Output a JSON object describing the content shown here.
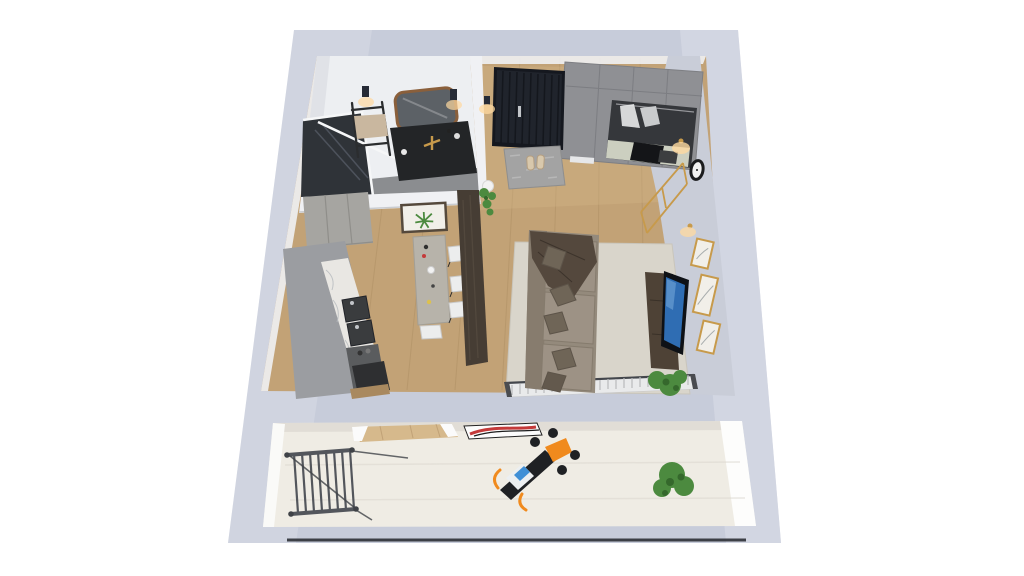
{
  "scene": {
    "title": "3d-apartment-floor-plan-render",
    "rooms": [
      "bathroom",
      "entry-hall",
      "wardrobe-nook",
      "kitchen",
      "dining-area",
      "living-area",
      "balcony"
    ],
    "objects": {
      "bathroom": [
        "walk-in-shower",
        "towel-ladder",
        "vanity-mirror",
        "vanity-sink",
        "wall-sconce",
        "wall-sconce"
      ],
      "entry_hall": [
        "entrance-door",
        "door-handle",
        "doormat",
        "slippers",
        "wall-sconce",
        "hanging-plant"
      ],
      "wardrobe_nook": [
        "wardrobe",
        "open-niche-with-clothes",
        "mattress",
        "black-pillow"
      ],
      "kitchen": [
        "tall-cabinets",
        "base-cabinets",
        "marble-countertop",
        "double-sink",
        "cooktop-oven"
      ],
      "dining_area": [
        "dining-table",
        "chair",
        "chair",
        "chair",
        "chair",
        "tableware"
      ],
      "living_area": [
        "area-rug",
        "sofa",
        "throw-blanket",
        "pillows",
        "tv-console",
        "tv",
        "potted-plant",
        "radiator",
        "wall-clock",
        "gold-coat-rack",
        "gallery-frame",
        "gallery-frame",
        "gallery-frame",
        "wall-sconce",
        "wall-sconce",
        "palm-artwork"
      ],
      "balcony": [
        "clothes-drying-rack",
        "exercise-bike",
        "potted-plant",
        "abstract-artwork"
      ]
    },
    "colors": {
      "background": "#ffffff",
      "wallSlab": "#c7ccda",
      "wallSlabLight": "#dde0e9",
      "wallInnerFace": "#c9cdd8",
      "wallWhite": "#f0f1f4",
      "bathWall": "#edeff2",
      "floorWood": "#c2a276",
      "floorWoodDark": "#ab8c62",
      "floorWoodLight": "#d6b98c",
      "balconyFloor": "#efece4",
      "balconyShade": "#dcd9d0",
      "bathFloor": "#8b8d90",
      "showerGlass": "#2f3338",
      "frameWhite": "#f6f7f8",
      "ladderFrame": "#2b2d2f",
      "towel": "#c9b79f",
      "mirrorFrame": "#8a5f3b",
      "mirrorGlass": "#5c6166",
      "vanityDark": "#232527",
      "gold": "#c79a4b",
      "doorNavy": "#20242c",
      "doorSlat": "#14171d",
      "handleSilver": "#c2c5c9",
      "sconceDark": "#262b36",
      "glowWarm": "#ffd9a0",
      "rugGray": "#a3a3a3",
      "slipper": "#d8c8ac",
      "wardrobeGray": "#8f9094",
      "wardrobeSeam": "#7a7b80",
      "nicheDark": "#35373b",
      "mattress": "#cccfc0",
      "pillowBlack": "#141518",
      "clockBlack": "#1b1c1e",
      "clockFace": "#f2f2f2",
      "artPaper": "#f1efe9",
      "kitchenCab": "#9b9da1",
      "kitchenUpper": "#a6a5a1",
      "marble": "#e9e7e3",
      "marbleVein": "#b9bcc0",
      "sinkDark": "#3a3c3e",
      "applianceDark": "#2e2f31",
      "tableTop": "#b7b3aa",
      "chairWhite": "#eceded",
      "partition": "#463d34",
      "rugLiving": "#d9d5cb",
      "sofaBody": "#948a7c",
      "sofaBack": "#877c6e",
      "sofaCushion": "#9d9285",
      "sofaPillow": "#6f6557",
      "throwDark": "#54483d",
      "consoleWood": "#4e4236",
      "tvBlack": "#0e1116",
      "tvScreen": "#2f6db3",
      "plantGreen": "#4c8a3f",
      "plantDark": "#35682c",
      "potWhite": "#f2f2f2",
      "radiatorWhite": "#e9eaeb",
      "radiatorFin": "#b9babc",
      "rackGray": "#53565c",
      "bikeBlack": "#1f2124",
      "bikeOrange": "#f08a1d",
      "bikeScreen": "#3f8fd6",
      "artRed": "#c43a3a",
      "shadowLine": "#23262b"
    }
  }
}
